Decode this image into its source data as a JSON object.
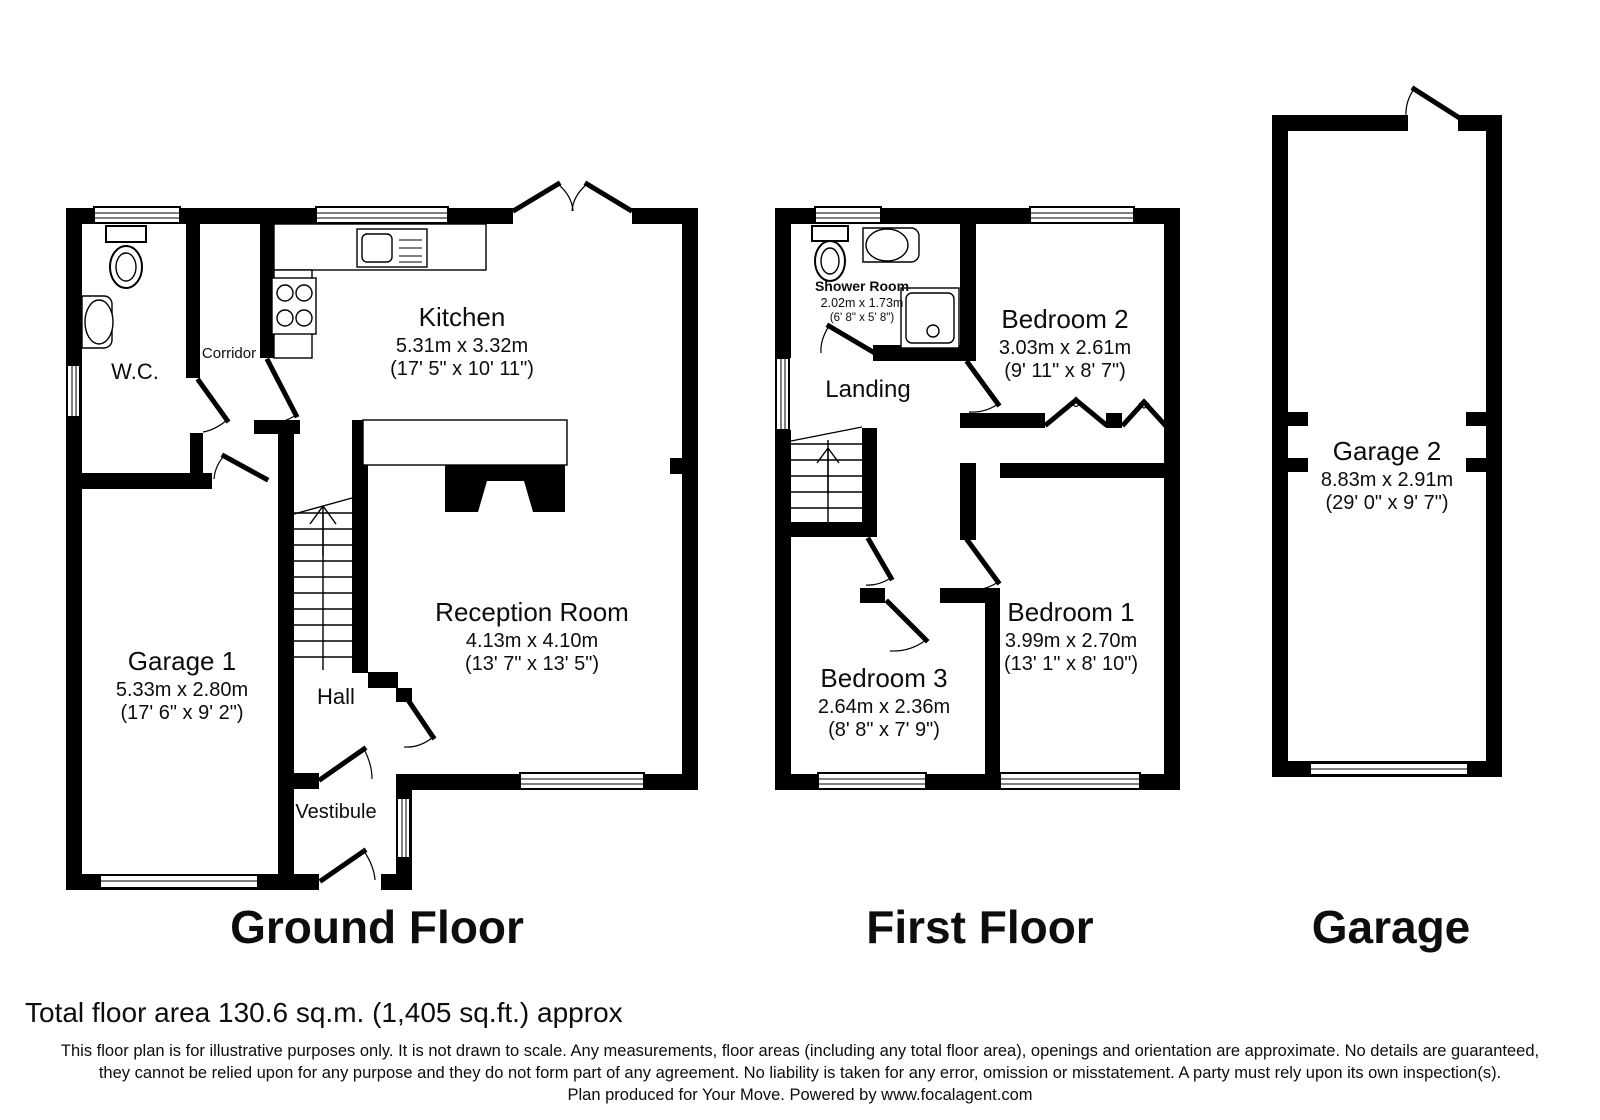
{
  "colors": {
    "wall": "#000000",
    "background": "#ffffff",
    "text": "#0d0d0d"
  },
  "floors": {
    "ground": {
      "title": "Ground Floor",
      "rooms": {
        "wc": {
          "name": "W.C."
        },
        "corridor": {
          "name": "Corridor"
        },
        "kitchen": {
          "name": "Kitchen",
          "dim_m": "5.31m x 3.32m",
          "dim_ft": "(17' 5\" x 10' 11\")"
        },
        "garage1": {
          "name": "Garage 1",
          "dim_m": "5.33m x 2.80m",
          "dim_ft": "(17' 6\" x 9' 2\")"
        },
        "hall": {
          "name": "Hall"
        },
        "reception": {
          "name": "Reception Room",
          "dim_m": "4.13m x 4.10m",
          "dim_ft": "(13' 7\" x 13' 5\")"
        },
        "vestibule": {
          "name": "Vestibule"
        }
      }
    },
    "first": {
      "title": "First Floor",
      "rooms": {
        "shower": {
          "name": "Shower Room",
          "dim_m": "2.02m x 1.73m",
          "dim_ft": "(6' 8\" x 5' 8\")"
        },
        "landing": {
          "name": "Landing"
        },
        "bedroom2": {
          "name": "Bedroom 2",
          "dim_m": "3.03m x 2.61m",
          "dim_ft": "(9' 11\" x 8' 7\")"
        },
        "bedroom1": {
          "name": "Bedroom 1",
          "dim_m": "3.99m x 2.70m",
          "dim_ft": "(13' 1\" x 8' 10\")"
        },
        "bedroom3": {
          "name": "Bedroom 3",
          "dim_m": "2.64m x 2.36m",
          "dim_ft": "(8' 8\" x 7' 9\")"
        }
      }
    },
    "garage": {
      "title": "Garage",
      "rooms": {
        "garage2": {
          "name": "Garage 2",
          "dim_m": "8.83m x 2.91m",
          "dim_ft": "(29' 0\" x 9' 7\")"
        }
      }
    }
  },
  "footer": {
    "total_area": "Total floor area 130.6 sq.m. (1,405 sq.ft.) approx",
    "disclaimer1": "This floor plan is for illustrative purposes only. It is not drawn to scale. Any measurements, floor areas (including any total floor area), openings and orientation are approximate. No details are guaranteed,",
    "disclaimer2": "they cannot be relied upon for any purpose and they do not form part of any agreement. No liability is taken for any error, omission or misstatement. A party must rely upon its own inspection(s).",
    "disclaimer3": "Plan produced for Your Move. Powered by www.focalagent.com"
  }
}
